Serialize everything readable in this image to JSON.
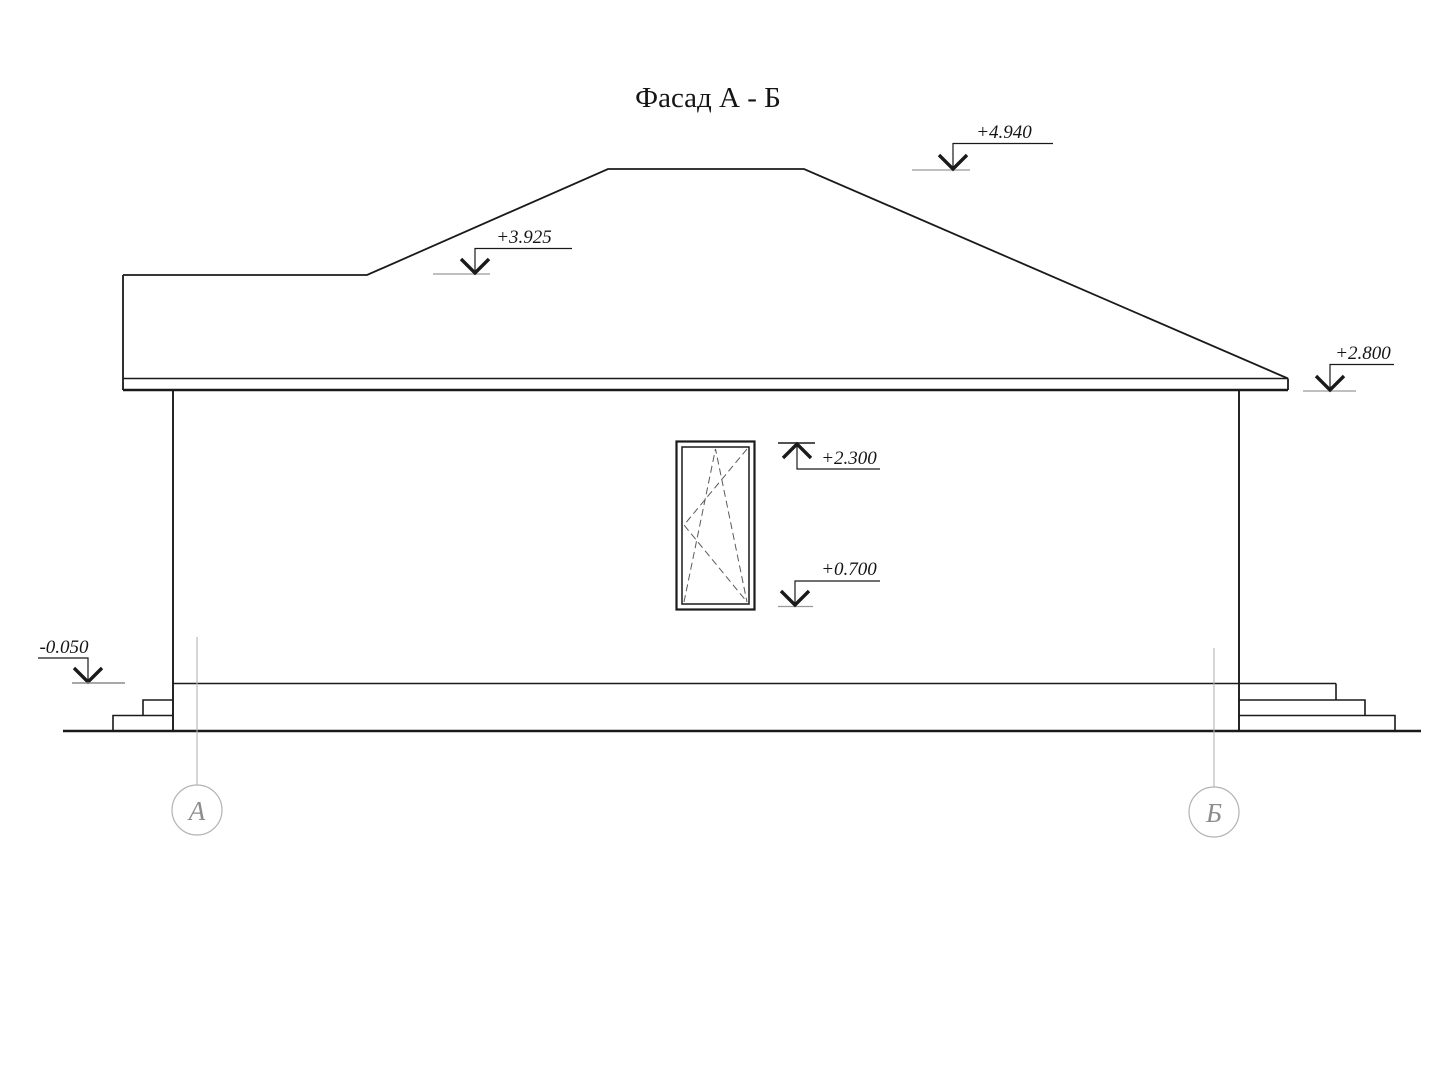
{
  "title": "Фасад А - Б",
  "drawing": {
    "type": "architectural-facade-elevation",
    "elevation_markers": [
      {
        "id": "ridge",
        "label": "+4.940",
        "direction": "down"
      },
      {
        "id": "roof-ledge",
        "label": "+3.925",
        "direction": "down"
      },
      {
        "id": "eaves",
        "label": "+2.800",
        "direction": "down"
      },
      {
        "id": "window-top",
        "label": "+2.300",
        "direction": "up"
      },
      {
        "id": "window-sill",
        "label": "+0.700",
        "direction": "down"
      },
      {
        "id": "plinth",
        "label": "-0.050",
        "direction": "down"
      }
    ],
    "axis_markers": [
      {
        "id": "left",
        "label": "А"
      },
      {
        "id": "right",
        "label": "Б"
      }
    ]
  },
  "colors": {
    "background": "#ffffff",
    "line": "#1a1a1a",
    "reference_line": "#999999",
    "axis_line": "#b3b3b3",
    "axis_text": "#8d8d8d",
    "dashed_sash": "#5a5a5a"
  }
}
